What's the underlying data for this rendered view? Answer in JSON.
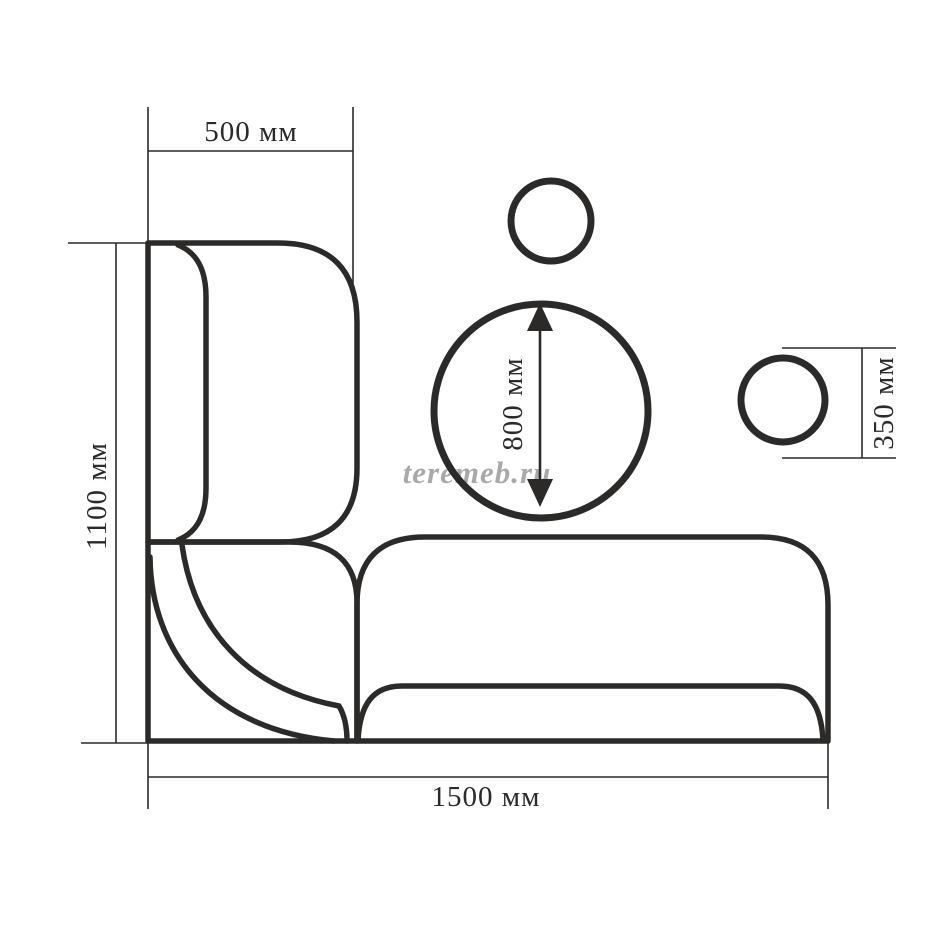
{
  "drawing": {
    "watermark": "teremeb.ru",
    "colors": {
      "line": "#2b2a29",
      "watermark": "#9b9b9b",
      "background": "#ffffff"
    },
    "dimensions": {
      "top_width": "500 мм",
      "left_length": "1100 мм",
      "table_diameter": "800 мм",
      "stool_diameter": "350 мм",
      "bottom_length": "1500 мм"
    }
  }
}
